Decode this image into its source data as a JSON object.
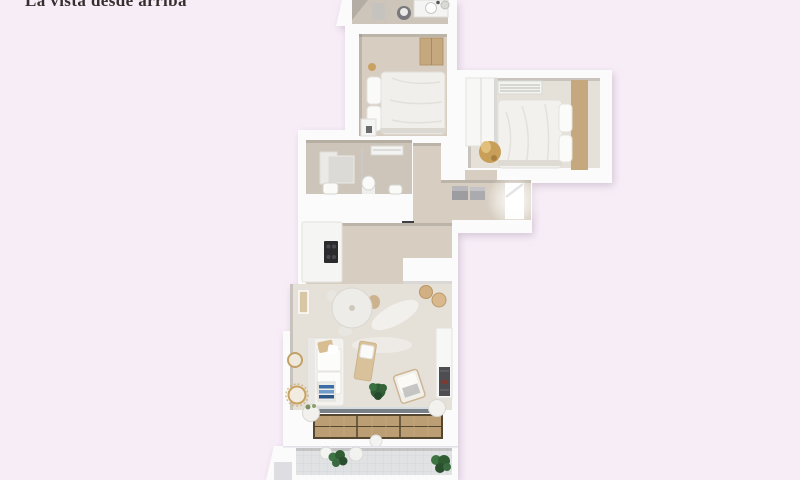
{
  "caption": "La vista desde arriba",
  "palette": {
    "bg": "#f7edf7",
    "ink": "#35302e",
    "wall": "#fbfbfc",
    "wall_shade": "#dfdfe6",
    "floor": "#d7cec1",
    "floor_dark": "#cdc5b9",
    "floor_light": "#e5e1d9",
    "wood": "#c5a87d",
    "deck": "#bb9e73",
    "deck_line": "#55462f",
    "glass": "#787f86",
    "plant": "#2f5c33",
    "accent_blue": "#3c6da6",
    "gold": "#c89f58",
    "tile": "#e0e2e4"
  },
  "scene": {
    "type": "3d-floorplan-top-view",
    "rooms": [
      "top-bathroom",
      "bedroom-1",
      "bedroom-2",
      "main-bathroom",
      "hallway-entry",
      "kitchen",
      "living-dining-room",
      "terrace-deck",
      "lower-balcony"
    ]
  }
}
